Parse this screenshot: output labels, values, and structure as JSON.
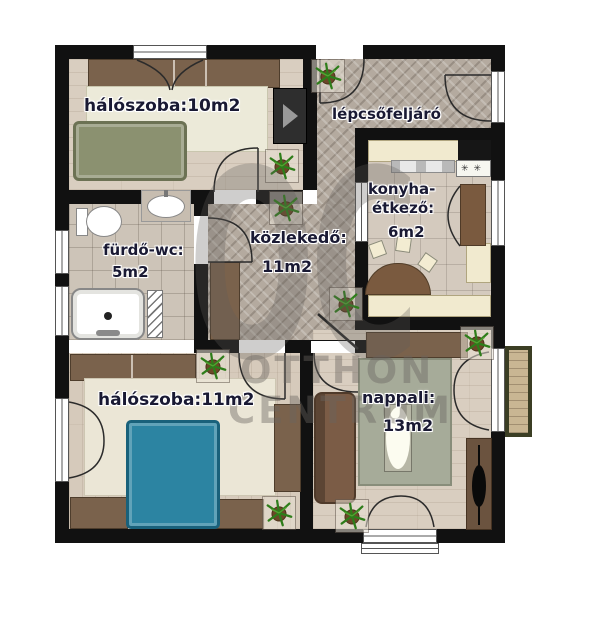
{
  "rooms": {
    "bedroom1": {
      "label": "hálószoba:10m2"
    },
    "staircase": {
      "label": "lépcsőfeljáró"
    },
    "kitchen": {
      "name_line1": "konyha-",
      "name_line2": "étkező:",
      "area": "6m2"
    },
    "bathroom": {
      "name": "fürdő-wc:",
      "area": "5m2"
    },
    "hallway": {
      "name": "közlekedő:",
      "area": "11m2"
    },
    "bedroom2": {
      "label": "hálószoba:11m2"
    },
    "living_room": {
      "name": "nappali:",
      "area": "13m2"
    }
  },
  "watermark": {
    "logo": "OC",
    "line1": "OTTHON",
    "line2": "CENTRUM"
  },
  "colors": {
    "wall": "#111111",
    "herringbone_floor": "#b4aa9f",
    "wood_floor": "#d9cec0",
    "tile_floor": "#cdc4b8",
    "bed_olive": "#8b9170",
    "bed_teal": "#2c84a2",
    "furniture_brown": "#7a624c",
    "counter_cream": "#f1eacf",
    "rug_cream": "#ebe6d6",
    "rug_sage": "#a6ab99",
    "plant_green": "#2e7d1a",
    "label_text": "#191933"
  }
}
